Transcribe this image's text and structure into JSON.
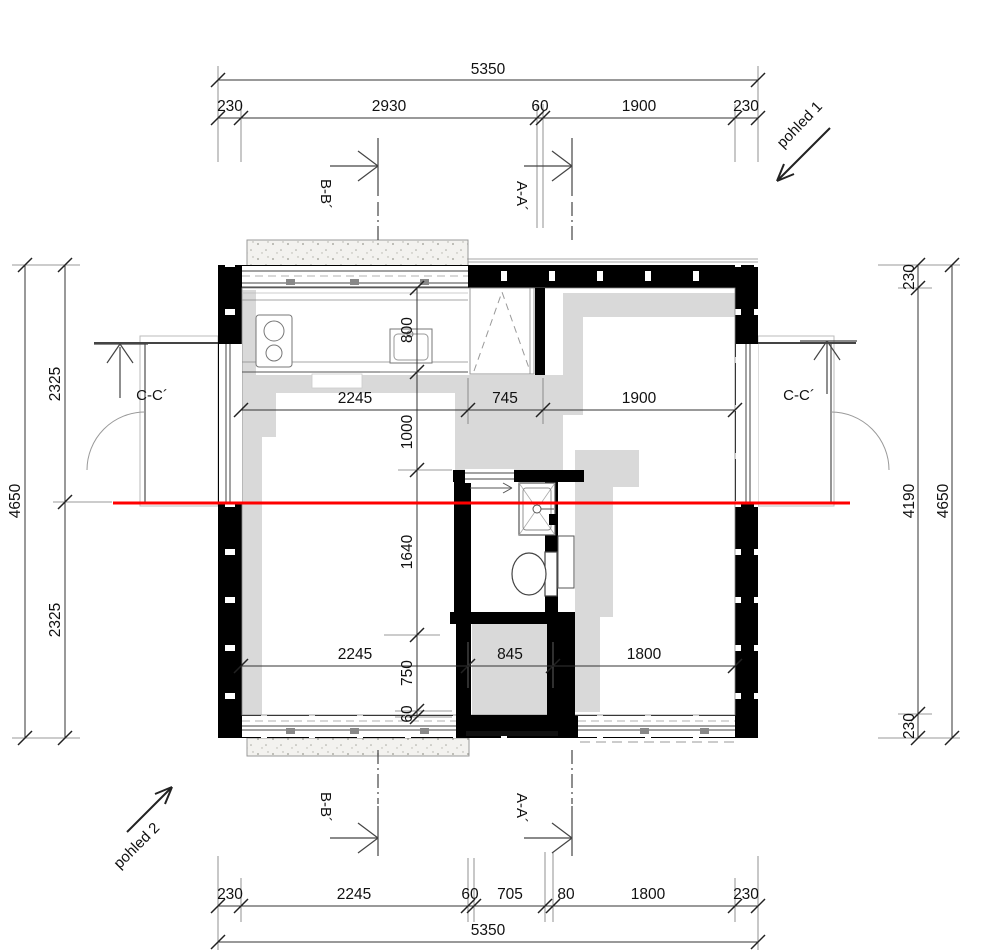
{
  "drawing": {
    "type": "architectural-floor-plan",
    "view_labels": {
      "pohled1": "pohled 1",
      "pohled2": "pohled 2"
    },
    "section_labels": {
      "aa": "A-A´",
      "bb": "B-B´",
      "cc": "C-C´"
    },
    "colors": {
      "section_cut_line": "#ff0000",
      "wall_fill": "#000000",
      "furniture_shade": "#d9d9d9"
    },
    "dimensions": {
      "top": {
        "total": "5350",
        "chain": [
          "230",
          "2930",
          "60",
          "1900",
          "230"
        ]
      },
      "bottom": {
        "total": "5350",
        "chain": [
          "230",
          "2245",
          "60",
          "705",
          "80",
          "1800",
          "230"
        ]
      },
      "left": {
        "total": "4650",
        "chain": [
          "2325",
          "2325"
        ]
      },
      "right": {
        "total": "4650",
        "chain": [
          "230",
          "4190",
          "230"
        ]
      },
      "interior": {
        "upper_row": [
          "2245",
          "745",
          "1900"
        ],
        "lower_row": [
          "2245",
          "845",
          "1800"
        ],
        "vertical": [
          "800",
          "1000",
          "1640",
          "750",
          "60"
        ]
      }
    }
  }
}
